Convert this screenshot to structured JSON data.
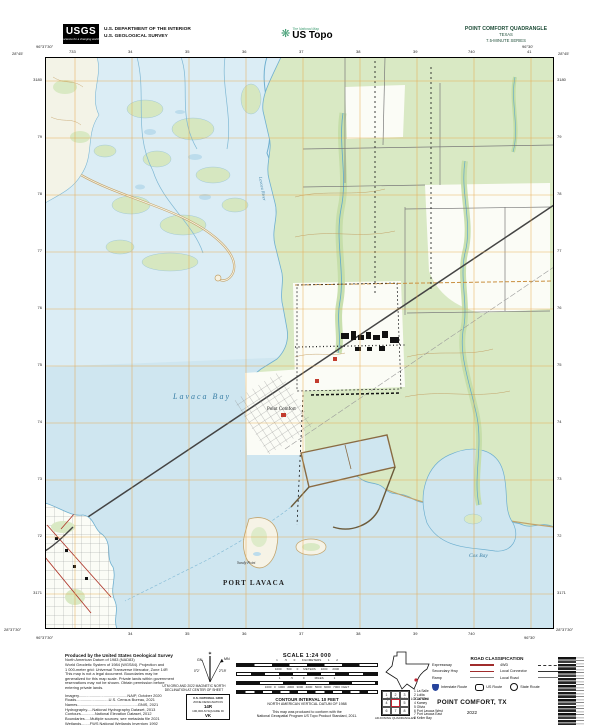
{
  "header": {
    "usgs": {
      "logo_text": "USGS",
      "tagline": "science for a changing world"
    },
    "dept_line1": "U.S. DEPARTMENT OF THE INTERIOR",
    "dept_line2": "U.S. GEOLOGICAL SURVEY",
    "ustopo": {
      "overline": "The National Map",
      "wordmark": "US Topo"
    },
    "quad": {
      "line1": "POINT COMFORT QUADRANGLE",
      "line2": "TEXAS",
      "line3": "7.5-MINUTE SERIES"
    }
  },
  "map": {
    "labels": {
      "bay": "Lavaca Bay",
      "town_port_lavaca": "PORT LAVACA",
      "sandy_point": "Sandy Point",
      "town_point_comfort": "Point Comfort",
      "cox_bay": "Cox Bay",
      "river": "Lavaca River"
    },
    "corners": {
      "tl_lon": "96°37'30\"",
      "tl_lat": "28°45'",
      "tr_lon": "96°30'",
      "tr_lat": "28°45'",
      "bl_lon": "96°37'30\"",
      "bl_lat": "28°37'30\"",
      "br_lon": "96°30'",
      "br_lat": "28°37'30\""
    },
    "ticks_top": [
      "733",
      "34",
      "35",
      "36",
      "37",
      "38",
      "39",
      "740",
      "41"
    ],
    "ticks_bottom": [
      "34",
      "35",
      "36",
      "37",
      "38",
      "39",
      "740"
    ],
    "ticks_left": [
      "3180",
      "79",
      "78",
      "77",
      "76",
      "75",
      "74",
      "73",
      "72",
      "3171"
    ],
    "ticks_right": [
      "3180",
      "79",
      "78",
      "77",
      "76",
      "75",
      "74",
      "73",
      "72",
      "3171"
    ]
  },
  "footer": {
    "credits_title": "Produced by the United States Geological Survey",
    "fineprint": [
      "North American Datum of 1983 (NAD83)",
      "World Geodetic System of 1984 (WGS84). Projection and",
      "1 000-meter grid: Universal Transverse Mercator, Zone 14R",
      "This map is not a legal document. Boundaries may be",
      "generalized for this map scale. Private lands within government",
      "reservations may not be shown. Obtain permission before",
      "entering private lands."
    ],
    "sources": [
      "Imagery.............................................NAIP, October 2020",
      "Roads..............................U.S. Census Bureau, 2021",
      "Names........................................................GNIS, 2021",
      "Hydrography.....National Hydrography Dataset, 2013",
      "Contours.............National Elevation Dataset, 2012",
      "Boundaries.....Multiple sources; see metadata file 2021",
      "Wetlands........FWS National Wetlands Inventory 1992"
    ],
    "declination": {
      "star": "✶",
      "gn": "GN",
      "mn": "MN",
      "gn_value": "0°2'",
      "mn_value": "2°19'",
      "caption1": "UTM GRID AND 2022 MAGNETIC NORTH",
      "caption2": "DECLINATION AT CENTER OF SHEET",
      "usng_title": "U.S. NATIONAL GRID",
      "usng_line1": "ZONE DESIGNATION",
      "usng_zone": "14R",
      "usng_line2": "100,000-M SQUARE ID",
      "usng_square": "VK"
    },
    "scale": {
      "title": "SCALE 1:24 000",
      "bar1_ticks": "1        .5        0        KILOMETERS        1        2",
      "bar2_ticks": "1000      500      0      METERS      1000      2000",
      "bar3_ticks": "1            .5            0            MILES            1",
      "bar4_ticks": "1000   0   1000   2000   3000   4000   5000   6000   7000  FEET",
      "contour": "CONTOUR INTERVAL 10 FEET",
      "datum": "NORTH AMERICAN VERTICAL DATUM OF 1988",
      "conform1": "This map was produced to conform with the",
      "conform2": "National Geospatial Program US Topo Product Standard, 2011."
    },
    "location_caption": "QUADRANGLE LOCATION",
    "adjoining": {
      "caption": "ADJOINING QUADRANGLES",
      "cells": [
        "1",
        "2",
        "3",
        "4",
        "5",
        "6",
        "7",
        "8"
      ],
      "names": [
        "1 La Salle",
        "2 Lolita",
        "3 La Ward",
        "4 Kamey",
        "5 Olivia",
        "6 Port Lavaca West",
        "7 Port Lavaca East",
        "8 Keller Bay"
      ]
    },
    "roads": {
      "title": "ROAD CLASSIFICATION",
      "col1": [
        {
          "label": "Expressway"
        },
        {
          "label": "Secondary Hwy"
        },
        {
          "label": "Ramp"
        }
      ],
      "col2": [
        {
          "label": "4WD"
        },
        {
          "label": "Local Connector"
        },
        {
          "label": "Local Road"
        }
      ],
      "shields": [
        {
          "label": "Interstate Route"
        },
        {
          "label": "US Route"
        },
        {
          "label": "State Route"
        }
      ]
    },
    "sheet_title": "POINT COMFORT, TX",
    "year": "2022"
  },
  "colors": {
    "water": "#cfe6f0",
    "marsh_water": "#dbedf5",
    "vegetation": "#d9e9c4",
    "grid": "#e8a545",
    "contour": "#c09a5e",
    "road_red": "#a02c2c",
    "interstate_blue": "#27449c",
    "quad_title_green": "#1e4d38"
  }
}
